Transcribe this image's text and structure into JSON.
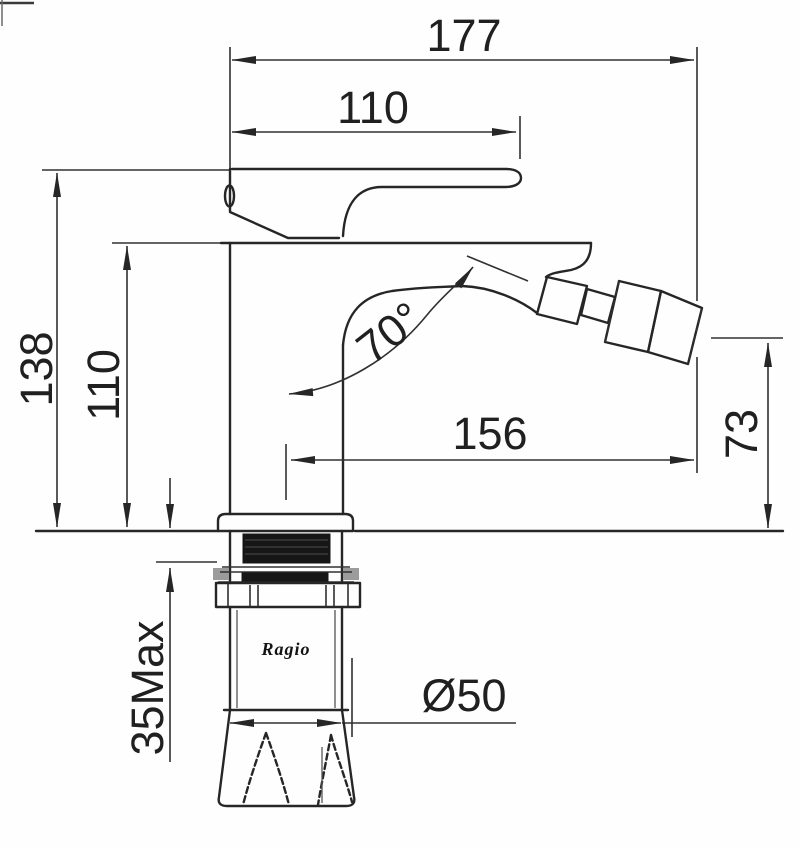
{
  "page": {
    "background_color": "#ffffff",
    "line_color": "#262626"
  },
  "drawing": {
    "brand_label": "Ragio",
    "dimensions": {
      "overall_length": "177",
      "handle_length": "110",
      "total_height": "138",
      "body_height": "110",
      "spray_angle": "70°",
      "spout_reach": "156",
      "outlet_height": "73",
      "max_mounting_thickness": "35Max",
      "base_diameter": "Ø50"
    }
  }
}
